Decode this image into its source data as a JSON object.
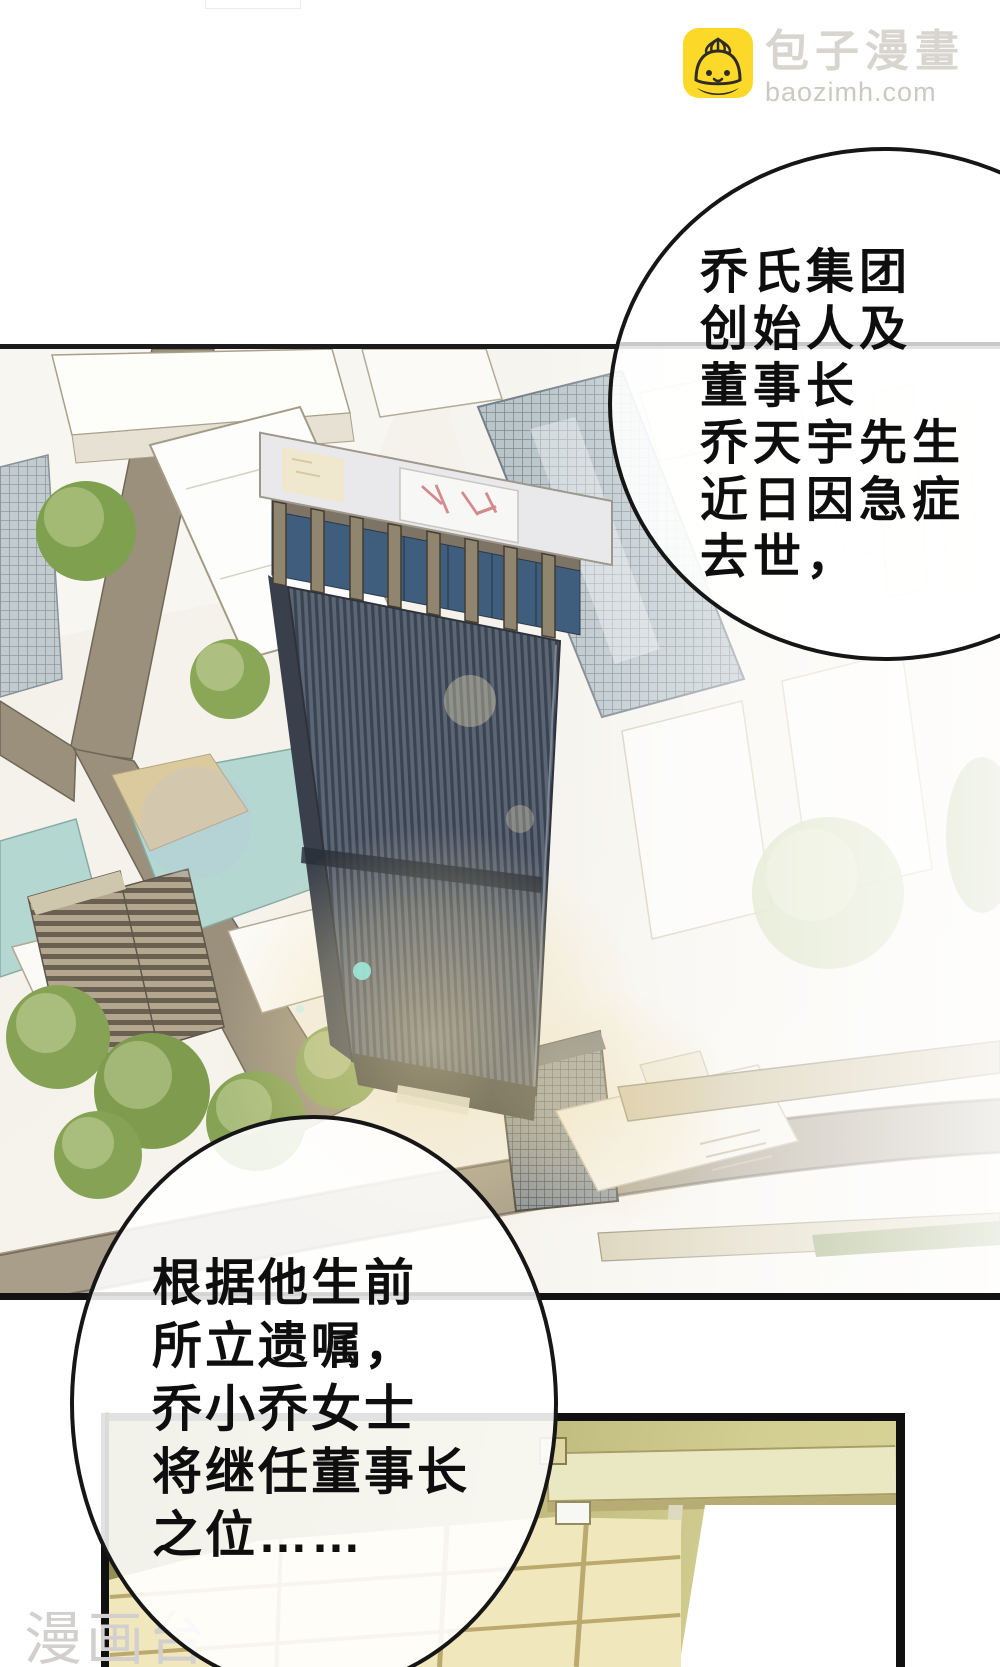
{
  "site": {
    "name": "包子漫畫",
    "domain": "baozimh.com",
    "icon": "baozi-bun-icon",
    "brand_yellow": "#fcd928",
    "logo_text_gray": "#d8d4ce"
  },
  "bubbles": [
    {
      "id": "narration-top",
      "lines": [
        "乔氏集团",
        "创始人及",
        "董事长",
        "乔天宇先生",
        "近日因急症",
        "去世，"
      ]
    },
    {
      "id": "narration-bottom",
      "lines": [
        "根据他生前",
        "所立遗嘱，",
        "乔小乔女士",
        "将继任董事长",
        "之位……"
      ]
    }
  ],
  "watermark": {
    "text": "漫画台",
    "color": "#d3cfce"
  },
  "scene_colors": {
    "panel_border": "#151515",
    "road": "#9a907c",
    "ring_road": "#a89e8a",
    "water": "#b5d7d1",
    "sand": "#dcca9f",
    "tree_green": "#86a355",
    "tower_stripe_dark": "#3a4352",
    "tower_stripe_light": "#5c6574",
    "tower_glass": "#3f5e7e",
    "roof_slab": "#e9e9eb",
    "helipad_marks": "#d4898c",
    "room_wall_olive": "#b3ae72",
    "room_beam": "#eae8c2",
    "room_floor": "#f0e8bc",
    "doorway_white": "#ffffff"
  }
}
